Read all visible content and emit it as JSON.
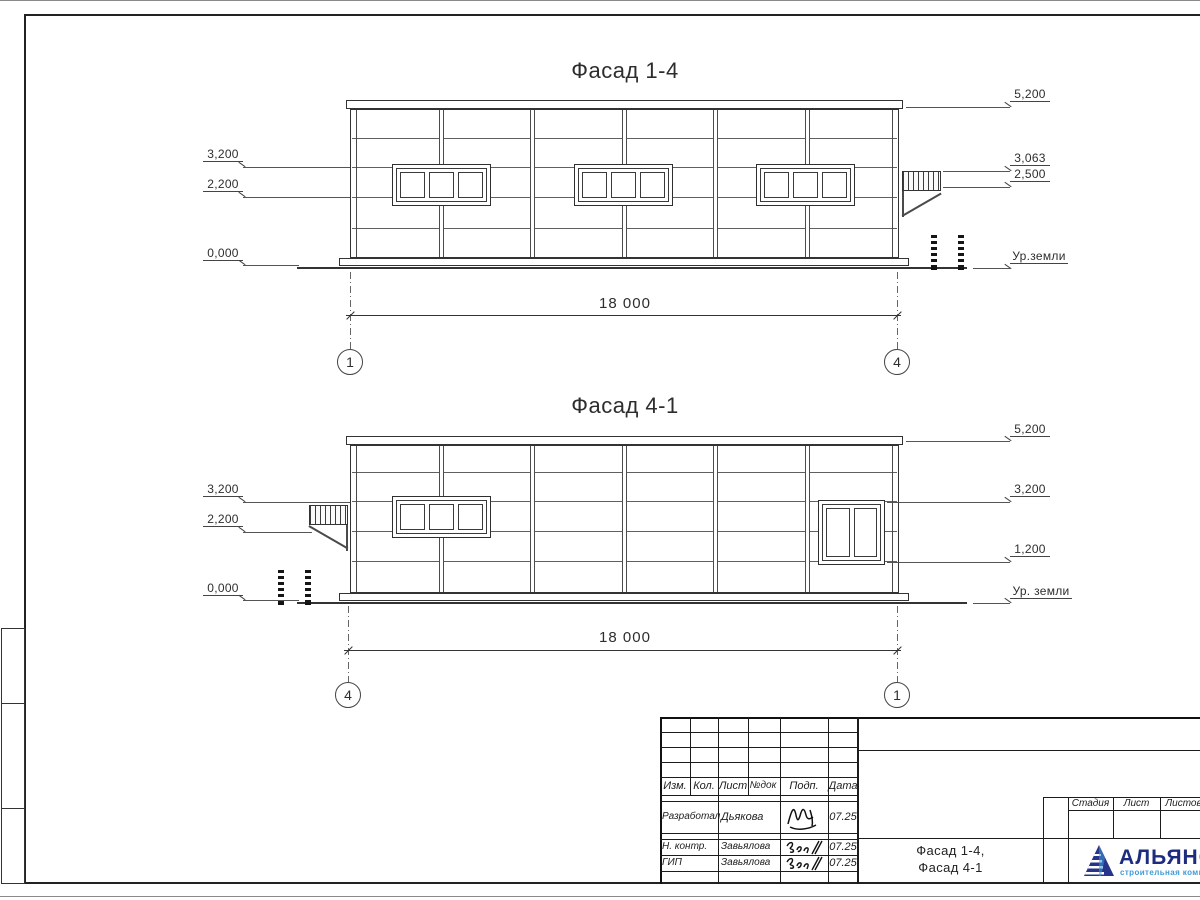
{
  "facade_top": {
    "title": "Фасад 1-4",
    "marks_left": [
      "3,200",
      "2,200",
      "0,000"
    ],
    "marks_right": [
      "5,200",
      "3,063",
      "2,500"
    ],
    "ground_label": "Ур.земли",
    "dimension": "18 000",
    "axis_left": "1",
    "axis_right": "4"
  },
  "facade_bottom": {
    "title": "Фасад 4-1",
    "marks_left": [
      "3,200",
      "2,200",
      "0,000"
    ],
    "marks_right": [
      "5,200",
      "3,200",
      "1,200"
    ],
    "ground_label": "Ур. земли",
    "dimension": "18 000",
    "axis_left": "4",
    "axis_right": "1"
  },
  "title_block": {
    "columns": [
      "Изм.",
      "Кол.",
      "Лист",
      "№док",
      "Подп.",
      "Дата"
    ],
    "rows": [
      {
        "role": "Разработал",
        "name": "Дьякова",
        "date": "07.25"
      },
      {
        "role": "Н. контр.",
        "name": "Завьялова",
        "date": "07.25"
      },
      {
        "role": "ГИП",
        "name": "Завьялова",
        "date": "07.25"
      }
    ],
    "sheet_title_line1": "Фасад 1-4,",
    "sheet_title_line2": "Фасад 4-1",
    "stage_columns": [
      "Стадия",
      "Лист",
      "Листов"
    ],
    "logo_name": "АЛЬЯНС",
    "logo_subtitle": "строительная компания",
    "colors": {
      "logo_navy": "#27348b",
      "logo_blue": "#3f9bd8"
    }
  }
}
